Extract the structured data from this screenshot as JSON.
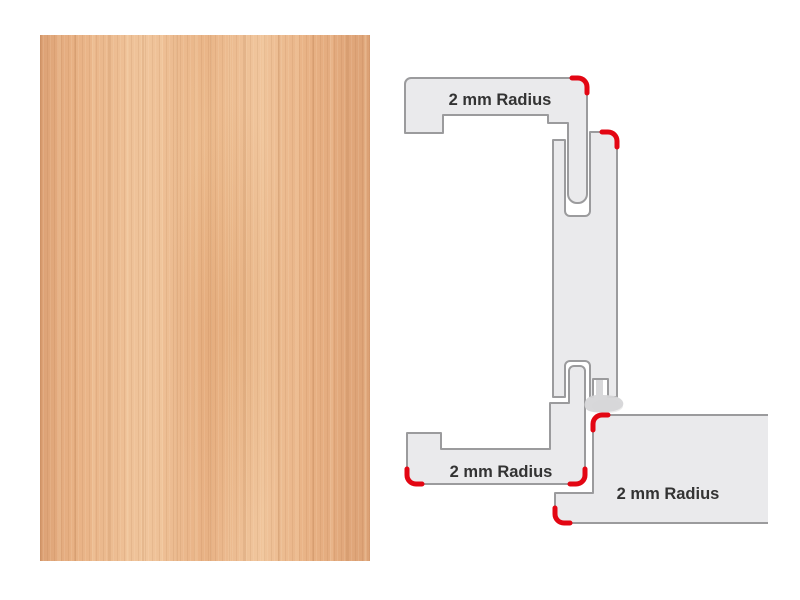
{
  "colors": {
    "page_bg": "#ffffff",
    "shape_fill": "#eaeaec",
    "shape_outline": "#9b9b9d",
    "radius_mark": "#e30613",
    "seal": "#d6d6d8",
    "label_text": "#333333",
    "wood_base": "#e8b184",
    "wood_light": "#f0c59c",
    "wood_deep": "#dca175"
  },
  "diagram": {
    "labels": {
      "top_profile_radius": "2 mm Radius",
      "bottom_profile_radius": "2 mm Radius",
      "door_leaf_radius": "2 mm Radius"
    }
  }
}
